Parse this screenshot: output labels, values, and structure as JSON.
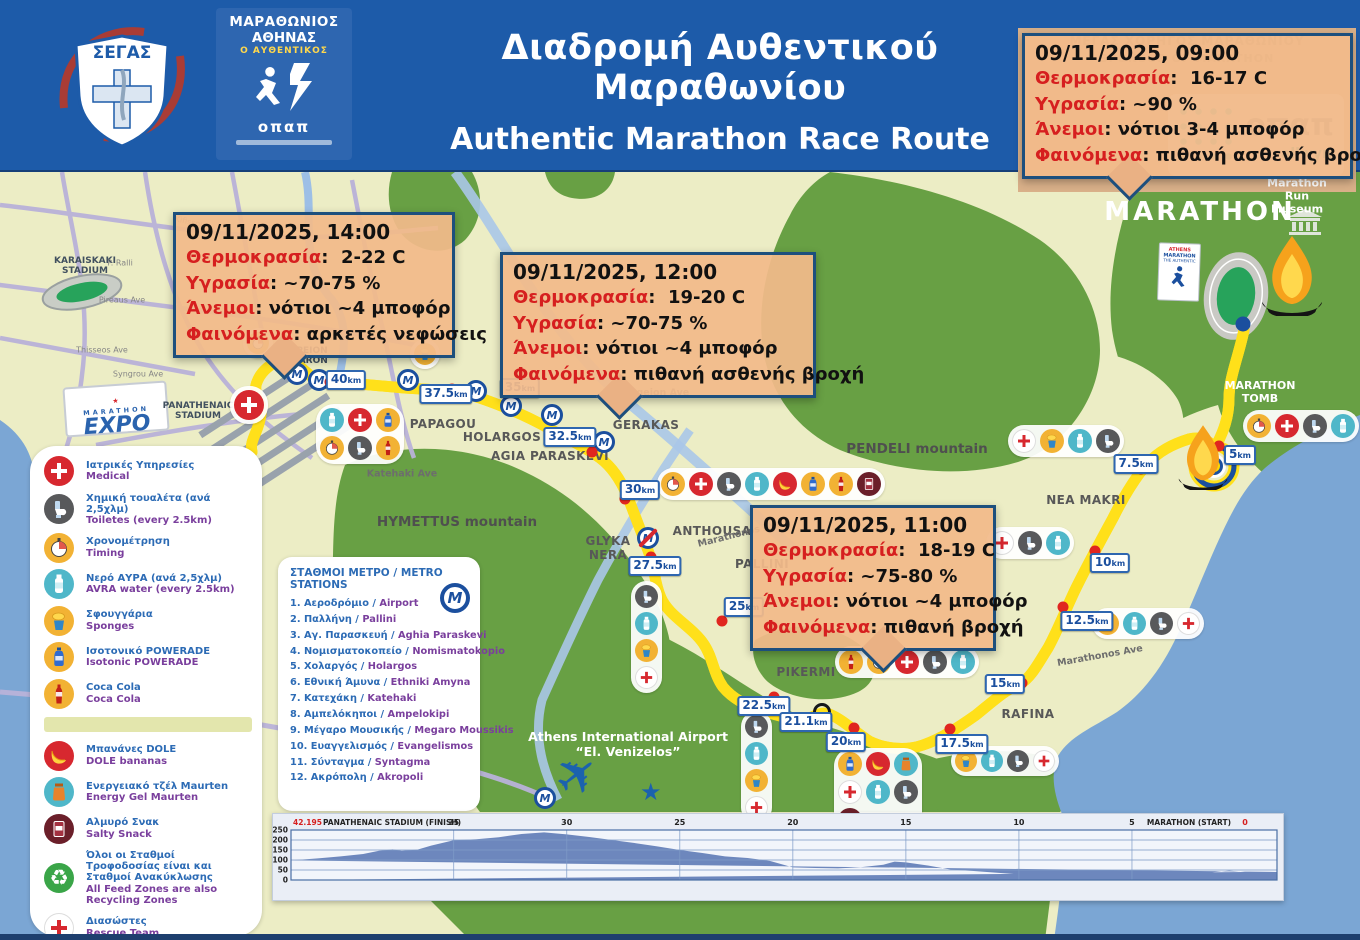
{
  "colors": {
    "header_blue": "#1d5ba9",
    "map_base": "#ecedc5",
    "green": "#68a044",
    "sea": "#7ba6d4",
    "route_blue": "#1b4f9e",
    "route_yellow": "#ffe01a",
    "box_bg": "#f2ba8a",
    "box_border": "#1d4f7d",
    "label_red": "#d61f1f",
    "chart_fill": "#6d87bd"
  },
  "header": {
    "segas_text": "ΣΕΓΑΣ",
    "race_logo": {
      "line1": "ΜΑΡΑΘΩΝΙΟΣ",
      "line2": "ΑΘΗΝΑΣ",
      "line3": "Ο ΑΥΘΕΝΤΙΚΟΣ",
      "brand": "οπαπ"
    },
    "title_gr": "Διαδρομή Αυθεντικού Μαραθωνίου",
    "title_en": "Authentic Marathon Race Route",
    "sponsor": {
      "line_gr": "ΜΕΓΑΣ ΧΟΡΗΓΟΣ ΜΑΡΑΘΩΝΙΟΥ",
      "line_en": "SPONSOR OF MARATHON",
      "opap": "οπαπ",
      "allwyn": "allwyn"
    }
  },
  "weather": [
    {
      "datetime": "09/11/2025, 09:00",
      "rows": [
        {
          "k": "Θερμοκρασία",
          "v": "16-17 C"
        },
        {
          "k": "Υγρασία",
          "v": "~90 %"
        },
        {
          "k": "Άνεμοι",
          "v": "νότιοι 3-4 μποφόρ"
        },
        {
          "k": "Φαινόμενα",
          "v": "πιθανή ασθενής βροχή"
        }
      ]
    },
    {
      "datetime": "09/11/2025, 14:00",
      "rows": [
        {
          "k": "Θερμοκρασία",
          "v": "2-22 C"
        },
        {
          "k": "Υγρασία",
          "v": "~70-75 %"
        },
        {
          "k": "Άνεμοι",
          "v": "νότιοι ~4 μποφόρ"
        },
        {
          "k": "Φαινόμενα",
          "v": "αρκετές νεφώσεις"
        }
      ]
    },
    {
      "datetime": "09/11/2025, 12:00",
      "rows": [
        {
          "k": "Θερμοκρασία",
          "v": "19-20 C"
        },
        {
          "k": "Υγρασία",
          "v": "~70-75 %"
        },
        {
          "k": "Άνεμοι",
          "v": "νότιοι ~4 μποφόρ"
        },
        {
          "k": "Φαινόμενα",
          "v": "πιθανή ασθενής βροχή"
        }
      ]
    },
    {
      "datetime": "09/11/2025, 11:00",
      "rows": [
        {
          "k": "Θερμοκρασία",
          "v": "18-19 C"
        },
        {
          "k": "Υγρασία",
          "v": "~75-80 %"
        },
        {
          "k": "Άνεμοι",
          "v": "νότιοι ~4 μποφόρ"
        },
        {
          "k": "Φαινόμενα",
          "v": "πιθανή βροχή"
        }
      ]
    }
  ],
  "legend": {
    "items": [
      {
        "icon": "medical",
        "gr": "Ιατρικές Υπηρεσίες",
        "en": "Medical"
      },
      {
        "icon": "toilet",
        "gr": "Χημική τουαλέτα (ανά 2,5χλμ)",
        "en": "Toiletes (every 2.5km)"
      },
      {
        "icon": "timing",
        "gr": "Χρονομέτρηση",
        "en": "Timing"
      },
      {
        "icon": "water",
        "gr": "Νερό ΑΥΡΑ (ανά 2,5χλμ)",
        "en": "AVRA water (every 2.5km)"
      },
      {
        "icon": "sponge",
        "gr": "Σφουγγάρια",
        "en": "Sponges"
      },
      {
        "icon": "powerade",
        "gr": "Ισοτονικό POWERADE",
        "en": "Isotonic POWERADE"
      },
      {
        "icon": "cola",
        "gr": "Coca Cola",
        "en": "Coca Cola"
      },
      {
        "icon": "banana",
        "gr": "Μπανάνες DOLE",
        "en": "DOLE bananas"
      },
      {
        "icon": "gel",
        "gr": "Ενεργειακό τζέλ Maurten",
        "en": "Energy Gel Maurten"
      },
      {
        "icon": "snack",
        "gr": "Αλμυρό Σνακ",
        "en": "Salty Snack"
      },
      {
        "icon": "recycle",
        "gr": "Όλοι οι Σταθμοί Τροφοδοσίας είναι και Σταθμοί Ανακύκλωσης",
        "en": "All Feed Zones are also Recycling Zones"
      },
      {
        "icon": "medical-white",
        "gr": "Διασώστες",
        "en": "Rescue Team"
      }
    ]
  },
  "metro_panel": {
    "title": "ΣΤΑΘΜΟΙ ΜΕΤΡΟ /  METRO STATIONS",
    "stations": [
      {
        "num": "1.",
        "gr": "Αεροδρόμιο /",
        "en": "Airport"
      },
      {
        "num": "2.",
        "gr": "Παλλήνη /",
        "en": "Pallini"
      },
      {
        "num": "3.",
        "gr": "Αγ. Παρασκευή /",
        "en": "Aghia Paraskevi"
      },
      {
        "num": "4.",
        "gr": "Νομισματοκοπείο /",
        "en": "Nomismatokopio"
      },
      {
        "num": "5.",
        "gr": "Χολαργός /",
        "en": "Holargos"
      },
      {
        "num": "6.",
        "gr": "Εθνική Άμυνα /",
        "en": "Ethniki Amyna"
      },
      {
        "num": "7.",
        "gr": "Κατεχάκη /",
        "en": "Katehaki"
      },
      {
        "num": "8.",
        "gr": "Αμπελόκηποι /",
        "en": "Ampelokipi"
      },
      {
        "num": "9.",
        "gr": "Μέγαρο Μουσικής /",
        "en": "Megaro Moussikis"
      },
      {
        "num": "10.",
        "gr": "Ευαγγελισμός /",
        "en": "Evangelismos"
      },
      {
        "num": "11.",
        "gr": "Σύνταγμα /",
        "en": "Syntagma"
      },
      {
        "num": "12.",
        "gr": "Ακρόπολη /",
        "en": "Akropoli"
      }
    ]
  },
  "map_labels": {
    "karaiskaki": "KARAISKAKI\nSTADIUM",
    "panathenaic": "PANATHENAIC\nSTADIUM",
    "zappeion": "ZAPPEION\nMEGARON",
    "papagou": "PAPAGOU",
    "holargos": "HOLARGOS",
    "agia_paraskevi": "AGIA PARASKEVI",
    "gerakas": "GERAKAS",
    "pendeli": "PENDELI mountain",
    "hymettus": "HYMETTUS mountain",
    "glyka": "GLYKA\nNERA",
    "anthousa": "ANTHOUSA",
    "pallini": "PALLINI",
    "nea_makri": "NEA MAKRI",
    "pikermi": "PIKERMI",
    "rafina": "RAFINA",
    "marathon": "MARATHON",
    "marathon_tomb": "MARATHON TOMB",
    "museum": "Marathon Run\nMuseum",
    "marathonos_a": "Marathonos Ave",
    "marathonos_b": "Marathonos Ave",
    "katehaki": "Katehaki Ave",
    "messogeion": "Messogeion Ave",
    "kifissou": "Kifissou",
    "pireaus": "Pireaus Ave",
    "thisseos": "Thisseos Ave",
    "syngrou": "Syngrou Ave",
    "p_ralli": "P. Ralli"
  },
  "km_unit": "km",
  "km_markers": [
    "40",
    "37.5",
    "35",
    "32.5",
    "30",
    "27.5",
    "25",
    "22.5",
    "21.1",
    "20",
    "17.5",
    "15",
    "12.5",
    "10",
    "7.5",
    "5"
  ],
  "feed_stations": [
    {
      "icons": [
        "water",
        "medical",
        "powerade",
        "timing",
        "toilet",
        "cola"
      ],
      "chunk": 3
    },
    {
      "icons": [
        "timing"
      ]
    },
    {
      "icons": [
        "sponge"
      ]
    },
    {
      "icons": [
        "timing",
        "medical",
        "toilet",
        "water",
        "banana",
        "powerade",
        "cola",
        "snack"
      ]
    },
    {
      "icons": [
        "toilet",
        "water",
        "sponge",
        "medical-white"
      ],
      "dir": "v"
    },
    {
      "icons": [
        "toilet",
        "water",
        "sponge",
        "medical-white"
      ],
      "dir": "v"
    },
    {
      "icons": [
        "cola",
        "timing",
        "medical",
        "toilet",
        "water"
      ]
    },
    {
      "icons": [
        "powerade",
        "banana",
        "gel",
        "medical-white",
        "water",
        "toilet",
        "snack"
      ],
      "chunk": 3
    },
    {
      "icons": [
        "sponge",
        "water",
        "toilet",
        "medical-white"
      ]
    },
    {
      "icons": [
        "sponge",
        "water",
        "toilet",
        "medical-white"
      ]
    },
    {
      "icons": [
        "medical-white",
        "toilet",
        "water"
      ]
    },
    {
      "icons": [
        "medical-white",
        "sponge",
        "water",
        "toilet"
      ]
    },
    {
      "icons": [
        "timing",
        "medical",
        "toilet",
        "water"
      ]
    },
    {
      "icons": [
        "medical"
      ]
    }
  ],
  "expo": {
    "top": "MARATHON",
    "main": "EXPO",
    "star": "★"
  },
  "athens_card": {
    "l1": "ATHENS",
    "l2": "MARATHON",
    "l3": "THE AUTHENTIC"
  },
  "airport": {
    "line1": "Athens International Airport",
    "line2": "“El. Venizelos”"
  },
  "chart_data": {
    "type": "area",
    "title": "Race elevation profile",
    "left_value": "42.195",
    "left_label": "PANATHENAIC STADIUM (FINISH)",
    "right_label": "MARATHON (START)",
    "right_value": "0",
    "x_unit": "km",
    "y_unit": "m",
    "x_range": [
      0,
      42.195
    ],
    "ylim": [
      0,
      250
    ],
    "x_ticks": [
      35,
      30,
      25,
      20,
      15,
      10,
      5
    ],
    "y_ticks": [
      0,
      50,
      100,
      150,
      200,
      250
    ],
    "points": [
      [
        0,
        40
      ],
      [
        0.7,
        47
      ],
      [
        1.5,
        38
      ],
      [
        3,
        28
      ],
      [
        5,
        24
      ],
      [
        7,
        20
      ],
      [
        9,
        24
      ],
      [
        10,
        28
      ],
      [
        12,
        45
      ],
      [
        13,
        52
      ],
      [
        14,
        72
      ],
      [
        15,
        88
      ],
      [
        15.5,
        92
      ],
      [
        16,
        76
      ],
      [
        17,
        64
      ],
      [
        18,
        58
      ],
      [
        19,
        60
      ],
      [
        20,
        63
      ],
      [
        21,
        95
      ],
      [
        22,
        110
      ],
      [
        23,
        118
      ],
      [
        24,
        135
      ],
      [
        25,
        150
      ],
      [
        26,
        168
      ],
      [
        27,
        185
      ],
      [
        28,
        200
      ],
      [
        29,
        215
      ],
      [
        30,
        228
      ],
      [
        31,
        238
      ],
      [
        32,
        230
      ],
      [
        33,
        214
      ],
      [
        34,
        204
      ],
      [
        35,
        199
      ],
      [
        36,
        172
      ],
      [
        36.6,
        152
      ],
      [
        37.3,
        146
      ],
      [
        37.7,
        153
      ],
      [
        38.3,
        146
      ],
      [
        39,
        130
      ],
      [
        40,
        118
      ],
      [
        41,
        108
      ],
      [
        42.195,
        98
      ]
    ]
  }
}
